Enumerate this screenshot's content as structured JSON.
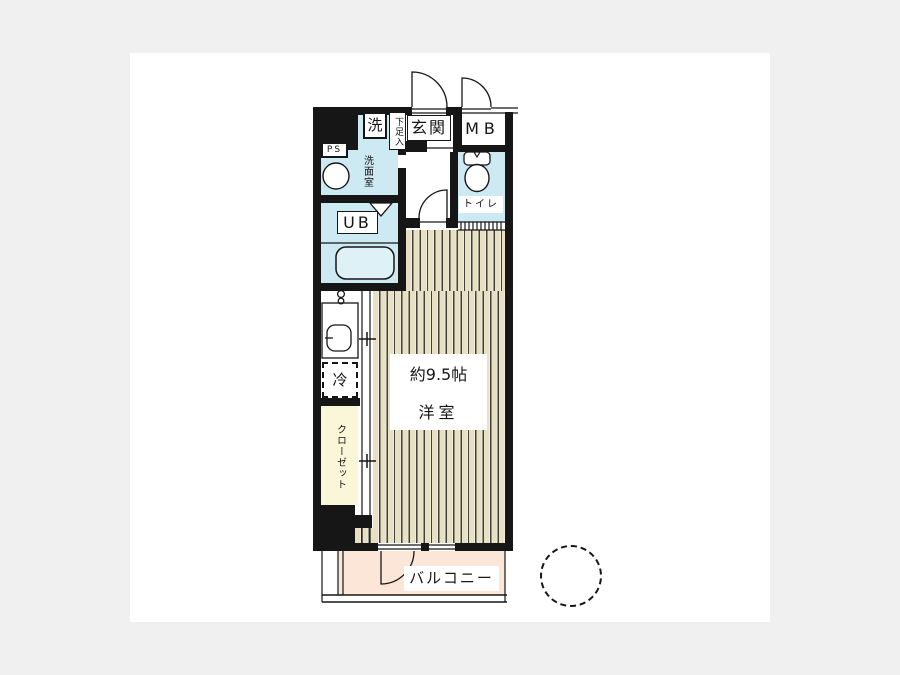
{
  "floorplan": {
    "labels": {
      "ps": "PS",
      "washer": "洗",
      "shoe_cabinet": "下足入",
      "entrance": "玄関",
      "meter_box": "MB",
      "washroom": "洗面室",
      "toilet": "トイレ",
      "unit_bath": "UB",
      "refrigerator": "冷",
      "closet": "クローゼット",
      "room_size": "約9.5帖",
      "room_type": "洋室",
      "balcony": "バルコニー"
    },
    "colors": {
      "page_background": "#f0f0f0",
      "canvas": "#ffffff",
      "wall": "#161616",
      "water_rooms": "#cdeaf3",
      "flooring_base": "#e8e0c4",
      "flooring_line": "#43403a",
      "closet": "#faf6d8",
      "balcony": "#fbe6d8",
      "bathtub": "#ddf1f7"
    }
  }
}
